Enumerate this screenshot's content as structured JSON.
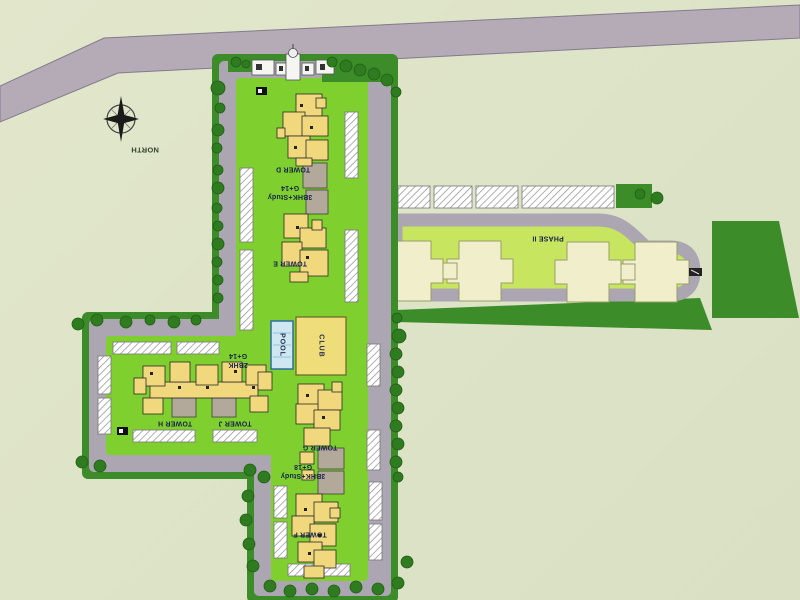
{
  "plan": {
    "compass_label": "NORTH",
    "phase_label": "PHASE II",
    "amenities": {
      "pool": "POOL",
      "club": "CLUB"
    },
    "towers": {
      "d": "TOWER D",
      "e": "TOWER E",
      "f": "TOWER F",
      "g": "TOWER G",
      "h": "TOWER H",
      "j": "TOWER J"
    },
    "specs": {
      "de": "3BHK+Study\nG+14",
      "hj": "2BHK\nG+14",
      "gf": "3BHK+Study\nG+18"
    },
    "colors": {
      "background": "#dfe4c9",
      "highway": "#b4abb7",
      "internal_road": "#aba6b2",
      "site_border_green": "#3c8d2a",
      "lawn": "#7fd02e",
      "phase2_lawn": "#c8e55f",
      "phase2_building": "#f0eecb",
      "tower_yellow": "#f2d87c",
      "tower_link_gray": "#b3a99b",
      "club_yellow": "#eedd78",
      "pool_blue": "#cfe7f0",
      "tree_green": "#2e7b20"
    }
  }
}
